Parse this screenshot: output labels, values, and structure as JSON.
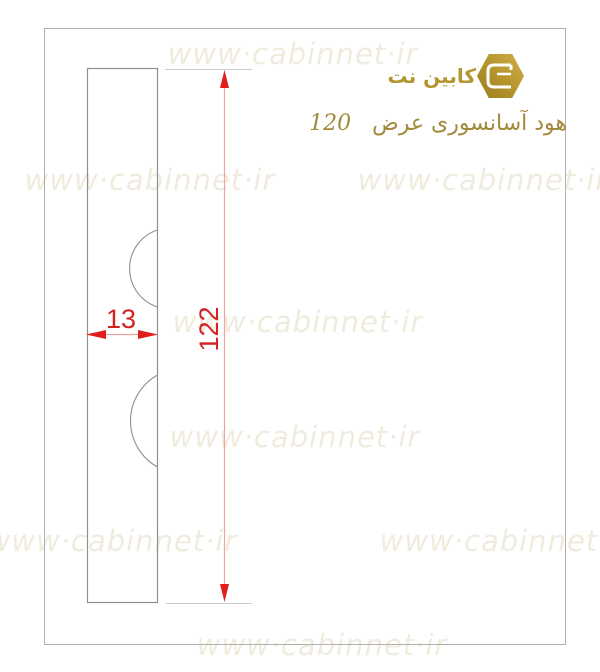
{
  "watermark": {
    "text": "www·cabinnet·ir",
    "color": "#f0ecdd"
  },
  "logo": {
    "brand": "کابین نت"
  },
  "title": {
    "text": "هود آسانسوری عرض",
    "number": "120"
  },
  "drawing": {
    "width_label": "13",
    "height_label": "122"
  },
  "colors": {
    "dimension_red": "#d42121",
    "arrow_red": "#e01e1e",
    "dim_line_pink": "#f0a49e",
    "outline_gray": "#909090",
    "frame_gray": "#b0b0b0",
    "brand_gold": "#b5952f",
    "title_gold": "#a3893a",
    "watermark_cream": "#f0ecdd"
  }
}
